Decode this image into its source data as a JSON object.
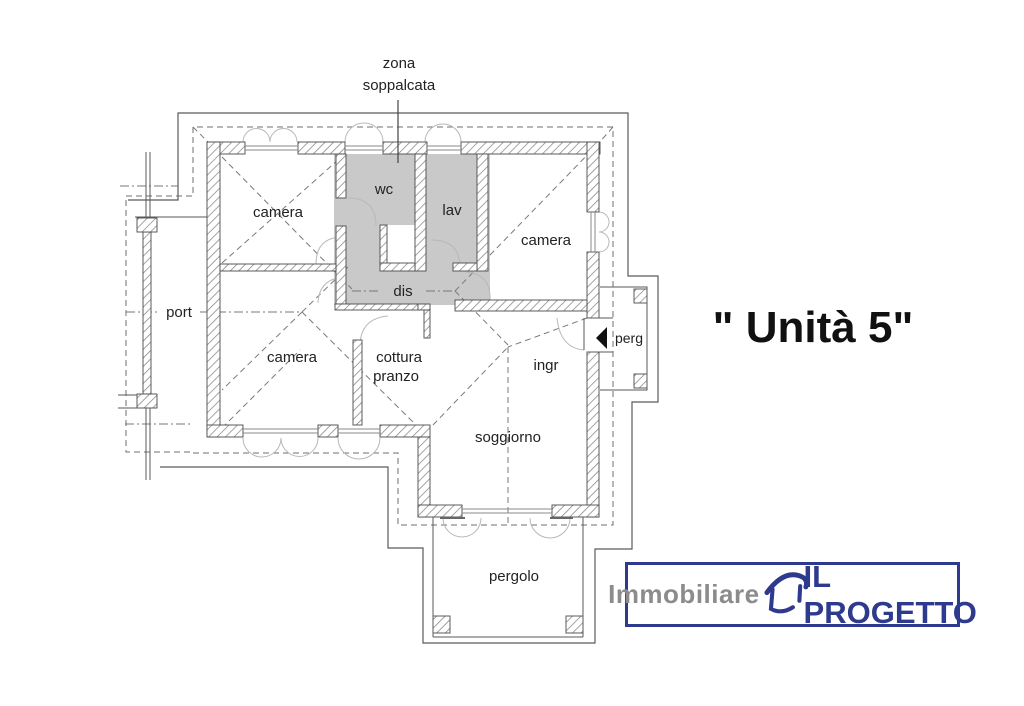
{
  "unit_title": "\" Unità 5\"",
  "plan": {
    "zona_label": {
      "line1": "zona",
      "line2": "soppalcata"
    },
    "rooms": {
      "camera_nw": "camera",
      "wc": "wc",
      "lav": "lav",
      "camera_e": "camera",
      "dis": "dis",
      "port": "port",
      "camera_w": "camera",
      "cottura_line1": "cottura",
      "cottura_line2": "pranzo",
      "ingr": "ingr",
      "perg": "perg",
      "soggiorno": "soggiorno",
      "pergolo": "pergolo"
    },
    "colors": {
      "service_area_fill": "#c9c9c9",
      "wall_outline": "#4a4a4a",
      "hatch_line": "#858585",
      "construction_line": "#777777",
      "door_swing_arc": "#b8b8b8",
      "label_text": "#222222",
      "entrance_arrow": "#111111"
    }
  },
  "logo": {
    "prefix": "Immobiliare",
    "name": "IL PROGETTO",
    "border_color": "#2e3a8e",
    "prefix_color": "#8c8c8c",
    "name_color": "#2e3a8e"
  }
}
